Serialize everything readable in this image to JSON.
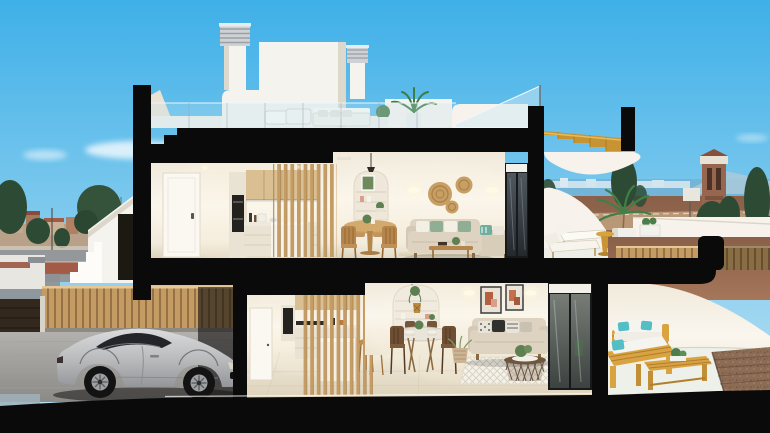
{
  "scene": {
    "type": "architectural-cutaway-3d-render",
    "description": "Cross-section 3D render of a two-storey coastal townhouse: roof terrace with chimneys and timber stair, furnished upper kitchen, dining and living room with terrace loungers, ground-floor garage with silver sports car, kitchen with slat screen, dining and living room, and an outdoor patio with timber furniture; blue sky, sea horizon, watchtower and town in the background",
    "background": [
      "blue-sky",
      "clouds",
      "town-skyline",
      "trees",
      "street",
      "sea-horizon",
      "watch-tower",
      "dirt-terrain",
      "timber-fence"
    ],
    "rooms": {
      "roof_terrace": "two chimneys, penthouse volume, loungers, outdoor sofa, potted plants, glass balustrade, gold timber staircase",
      "upper_kitchen": "white interior door, timber wall cabinets, oven column, white island, timber slat screen",
      "upper_dining": "round timber table, four spindle chairs, arched shelving niche, pendant lamp",
      "upper_living": "beige sofa with sage cushions, rattan wall plates, wall sconces, timber coffee table, striped rug, dark sliding glass door",
      "upper_terrace": "two sun loungers, gold pedestal side table, potted palm, white parapet",
      "garage": "silver sports car, timber slat fence, dark garage door, paved floor",
      "lower_kitchen": "timber slat screen, wall units, island, two bar stools",
      "lower_dining": "round glass table, four dark timber chairs, arched shelving niche, pendant lamp",
      "lower_living": "beige sofa with patterned cushions, two framed artworks, sconces, rattan basket coffee table, diamond rug, dark sliding glass door",
      "patio": "timber outdoor sofa, timber bench with white cushions and teal pillows, slatted coffee table, gravel bed with pergola shadow"
    }
  },
  "palette": {
    "sky-top": "#3fb0e8",
    "sky-horizon": "#bfe3f3",
    "cut-black": "#0a0a0a",
    "wall-white": "#f7f3ec",
    "wall-shade": "#eae2d3",
    "exterior-white": "#f4f3ee",
    "floor-light": "#ece4d3",
    "tile-floor": "#e7decb",
    "rug-white": "#f4f1e9",
    "wood-slat": "#c59c63",
    "wood-dark": "#9d7442",
    "cabinet-wood": "#dabf92",
    "gold-stair": "#c79434",
    "sofa-beige": "#ddd3c0",
    "pillow-green": "#8fae93",
    "pillow-teal": "#54bec6",
    "patio-wood": "#d9a342",
    "car-silver-light": "#d9dbdc",
    "car-silver-dark": "#94969a",
    "glass-dark": "#23262b",
    "frame-dark": "#17191c",
    "fence-wood": "#c49c63",
    "sea-blue": "#74b4d6",
    "mountain-blue": "#a9c9da",
    "terrain-brown": "#9c6a4e",
    "road-tan": "#c0a07f",
    "tree-dark": "#2d4b34",
    "street-gray": "#95989a",
    "sidewalk-red": "#a35b48",
    "tower-brick": "#96674e",
    "gravel-brown": "#8d6c55"
  }
}
